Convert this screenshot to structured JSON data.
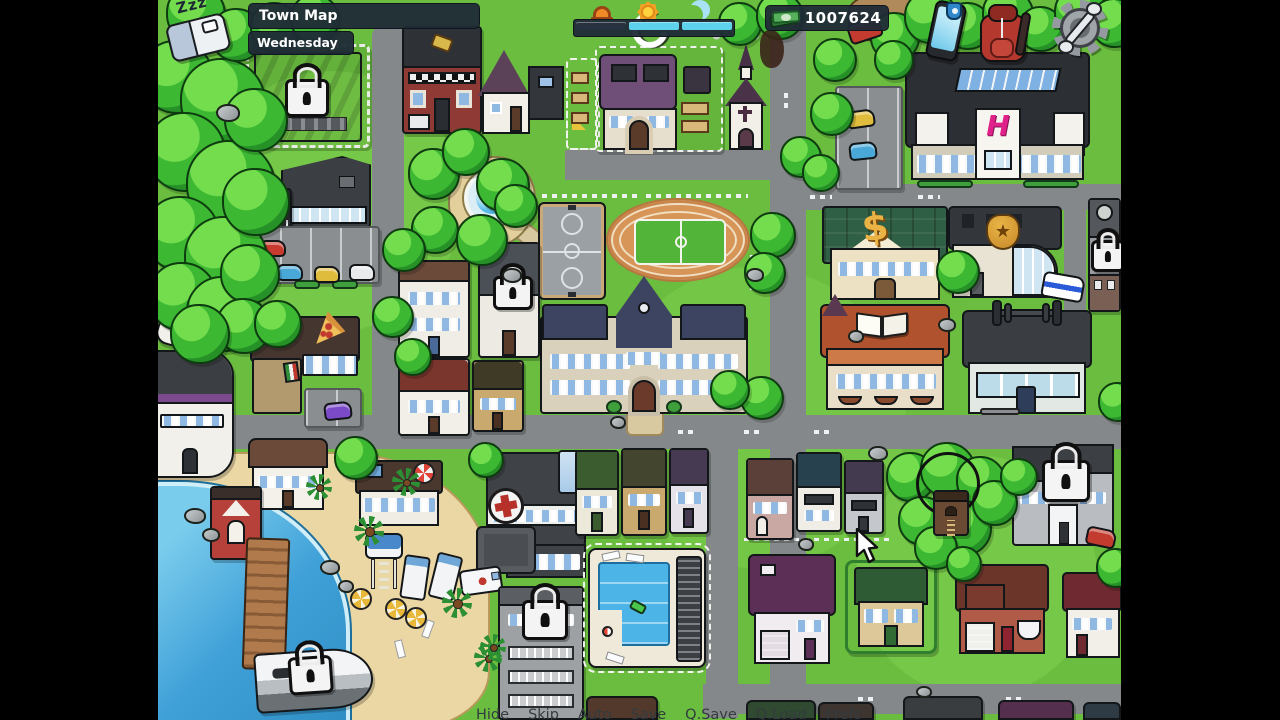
{
  "hud": {
    "location_label": "Town Map",
    "day_label": "Wednesday",
    "sleep": {
      "zzz_text": "Zzz"
    },
    "money": {
      "value": "1007624"
    },
    "time_of_day": {
      "segments": [
        {
          "name": "morning",
          "filled": false
        },
        {
          "name": "afternoon",
          "filled": true
        },
        {
          "name": "evening",
          "filled": true
        }
      ]
    }
  },
  "toolbar_icons": {
    "sleep": "bed-icon",
    "phone": "smartphone-icon",
    "inventory": "backpack-icon",
    "settings": "gear-wrench-icon",
    "money": "cash-icon",
    "time": [
      "sunrise-icon",
      "sun-icon",
      "moon-icon"
    ]
  },
  "map_badges": {
    "mall_logo": "H",
    "bank_sign": "$",
    "police_star": "★"
  },
  "map_locations": [
    {
      "id": "factory",
      "locked": true
    },
    {
      "id": "department-store"
    },
    {
      "id": "pizzeria",
      "icon": "pizza-slice-icon"
    },
    {
      "id": "strip-club"
    },
    {
      "id": "camper-van"
    },
    {
      "id": "tattoo-parlor"
    },
    {
      "id": "neighbor-house"
    },
    {
      "id": "player-home",
      "icon": "refresh-arrow-icon"
    },
    {
      "id": "church",
      "icon": "cross-icon"
    },
    {
      "id": "fountain-park"
    },
    {
      "id": "basketball-court"
    },
    {
      "id": "running-track"
    },
    {
      "id": "school"
    },
    {
      "id": "locked-house",
      "locked": true
    },
    {
      "id": "mall",
      "icon": "h-logo"
    },
    {
      "id": "bank",
      "icon": "dollar-icon"
    },
    {
      "id": "police-station",
      "icon": "star-badge-icon"
    },
    {
      "id": "locked-tower",
      "locked": true
    },
    {
      "id": "library",
      "icon": "open-book-icon"
    },
    {
      "id": "gym",
      "icon": "dumbbell-icon"
    },
    {
      "id": "hospital",
      "icon": "red-cross-icon"
    },
    {
      "id": "apartment-building",
      "locked": true
    },
    {
      "id": "public-pool"
    },
    {
      "id": "beach"
    },
    {
      "id": "pier"
    },
    {
      "id": "boat",
      "locked": true
    },
    {
      "id": "treehouse"
    },
    {
      "id": "locked-mansion",
      "locked": true
    },
    {
      "id": "suburb-houses"
    }
  ],
  "quick_menu": {
    "items": [
      {
        "label": "Hide"
      },
      {
        "label": "Skip"
      },
      {
        "label": "Auto"
      },
      {
        "label": "Save"
      },
      {
        "label": "Q.Save"
      },
      {
        "label": "Q.Load"
      },
      {
        "label": "Prefs"
      }
    ]
  },
  "colors": {
    "hud_bar": "#232d39",
    "time_fill": "#5ed1ec",
    "time_past": "#27313f",
    "money_text": "#ffffff",
    "mall_logo_pink": "#e0218a",
    "bank_gold": "#eab344",
    "grass": "#6abd3f",
    "road": "#85888a",
    "water": "#3fa0d8",
    "sand": "#ead7a4"
  }
}
